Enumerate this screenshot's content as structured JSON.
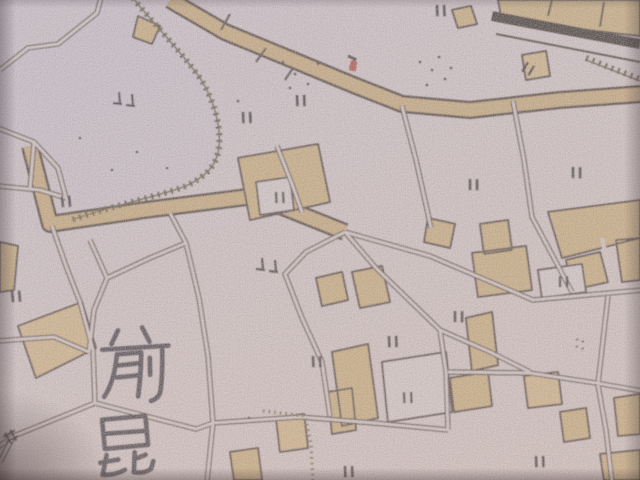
{
  "meta": {
    "alt_text": "Blurry close-up photograph of an old printed Japanese city map: tan building blocks, double-line streets, a hatched embankment around a large open area, a dark moat band with a walled compound at the top right, scattered double-tick map symbols, a small red landmark mark, and two large kanji place-name characters."
  },
  "labels": {
    "district_top_char": "前",
    "district_bottom_char": "昆",
    "district_reading": "前昆 (partial vertical place name)"
  },
  "colors": {
    "paper": "#d3c5c4",
    "paper-hi": "#cdc2cb",
    "paper-warm": "#d8c9c2",
    "block-tan": "#c9a86b",
    "block-tan-light": "#d2b177",
    "road-casing": "#352820",
    "road-fill": "#d5c8c5",
    "band-fill": "#c6a368",
    "band-casing": "#2e2119",
    "thick-band": "#1e1210",
    "hatch": "#4a4026",
    "stream": "#5a5738",
    "symbol-ink": "#241c1a",
    "kanji-ink": "#26202a",
    "red-marker": "#a83527",
    "white-building": "#d8cccb"
  },
  "marker": {
    "name": "red-landmark-marker",
    "x": 352,
    "y": 64
  },
  "symbols": [
    {
      "type": "pair",
      "x": 297,
      "y": 95,
      "rot": 8
    },
    {
      "type": "pair",
      "x": 243,
      "y": 112,
      "rot": 8
    },
    {
      "type": "pair",
      "x": 62,
      "y": 196,
      "rot": 5
    },
    {
      "type": "pair",
      "x": 276,
      "y": 192,
      "rot": 8
    },
    {
      "type": "pair",
      "x": 470,
      "y": 179,
      "rot": 10
    },
    {
      "type": "pair",
      "x": 573,
      "y": 167,
      "rot": 10
    },
    {
      "type": "pair",
      "x": 455,
      "y": 311,
      "rot": 10
    },
    {
      "type": "pair",
      "x": 389,
      "y": 336,
      "rot": 8
    },
    {
      "type": "pair",
      "x": 313,
      "y": 356,
      "rot": 8
    },
    {
      "type": "pair",
      "x": 404,
      "y": 392,
      "rot": 8
    },
    {
      "type": "pair",
      "x": 560,
      "y": 276,
      "rot": 10
    },
    {
      "type": "pair",
      "x": 536,
      "y": 456,
      "rot": 8
    },
    {
      "type": "pair",
      "x": 345,
      "y": 466,
      "rot": 8
    },
    {
      "type": "pair",
      "x": 437,
      "y": 5,
      "rot": 8
    },
    {
      "type": "pair",
      "x": 528,
      "y": 62,
      "rot": 40
    },
    {
      "type": "pair",
      "x": 12,
      "y": 291,
      "rot": 5
    },
    {
      "type": "feet",
      "x": 119,
      "y": 92,
      "rot": 0
    },
    {
      "type": "feet",
      "x": 262,
      "y": 258,
      "rot": 0
    },
    {
      "type": "quad",
      "x": 577,
      "y": 339,
      "rot": 10
    },
    {
      "type": "cross",
      "x": 5,
      "y": 433,
      "rot": -20
    }
  ],
  "specks": [
    [
      420,
      62
    ],
    [
      432,
      70
    ],
    [
      445,
      79
    ],
    [
      427,
      85
    ],
    [
      439,
      57
    ],
    [
      451,
      68
    ],
    [
      283,
      62
    ],
    [
      295,
      74
    ],
    [
      308,
      84
    ],
    [
      290,
      88
    ],
    [
      318,
      64
    ],
    [
      80,
      138
    ],
    [
      137,
      152
    ],
    [
      167,
      168
    ],
    [
      112,
      170
    ],
    [
      249,
      418
    ],
    [
      238,
      101
    ]
  ]
}
